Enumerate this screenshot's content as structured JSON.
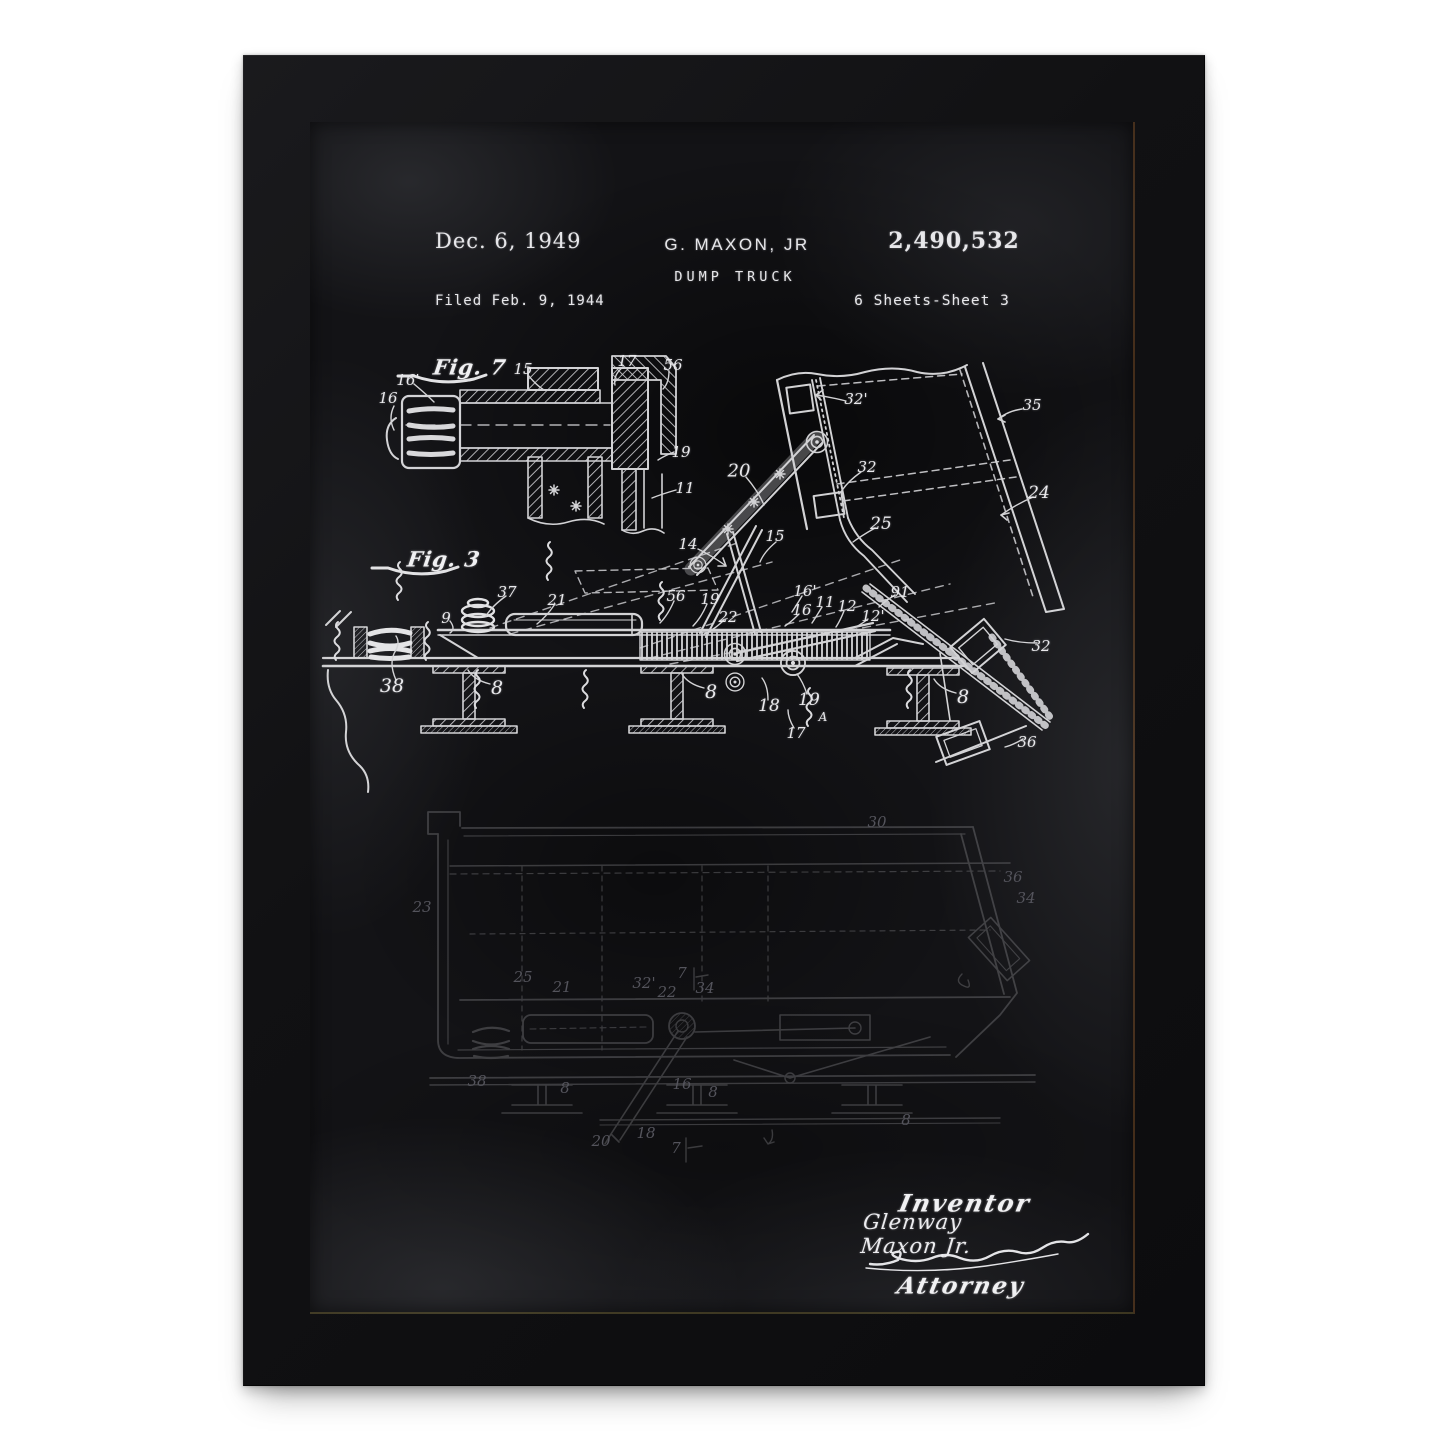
{
  "header": {
    "date": "Dec. 6, 1949",
    "inventor": "G. MAXON, JR",
    "title": "DUMP TRUCK",
    "patent_number": "2,490,532",
    "filed": "Filed Feb. 9, 1944",
    "sheet": "6 Sheets-Sheet 3"
  },
  "figures": {
    "fig7": {
      "label": "Fig. 7"
    },
    "fig3": {
      "label": "Fig. 3"
    }
  },
  "part_labels": {
    "fig7": [
      {
        "t": "16'",
        "x": 98,
        "y": 258
      },
      {
        "t": "16",
        "x": 78,
        "y": 276
      },
      {
        "t": "15",
        "x": 213,
        "y": 247
      },
      {
        "t": "17",
        "x": 317,
        "y": 239
      },
      {
        "t": "56",
        "x": 363,
        "y": 243
      },
      {
        "t": "19",
        "x": 371,
        "y": 330
      },
      {
        "t": "11",
        "x": 375,
        "y": 366
      }
    ],
    "fig3": [
      {
        "t": "14",
        "x": 378,
        "y": 422
      },
      {
        "t": "37",
        "x": 197,
        "y": 470
      },
      {
        "t": "21",
        "x": 247,
        "y": 478
      },
      {
        "t": "9",
        "x": 136,
        "y": 496
      },
      {
        "t": "56",
        "x": 366,
        "y": 474
      },
      {
        "t": "19",
        "x": 400,
        "y": 477
      },
      {
        "t": "22",
        "x": 418,
        "y": 495
      },
      {
        "t": "38",
        "x": 82,
        "y": 564,
        "s": 19
      },
      {
        "t": "8",
        "x": 187,
        "y": 566,
        "s": 19
      },
      {
        "t": "8",
        "x": 401,
        "y": 570,
        "s": 19
      },
      {
        "t": "8",
        "x": 653,
        "y": 575,
        "s": 19
      },
      {
        "t": "20",
        "x": 429,
        "y": 349,
        "s": 18
      },
      {
        "t": "32'",
        "x": 546,
        "y": 277
      },
      {
        "t": "35",
        "x": 722,
        "y": 283
      },
      {
        "t": "32",
        "x": 557,
        "y": 345
      },
      {
        "t": "24",
        "x": 729,
        "y": 371,
        "s": 17
      },
      {
        "t": "25",
        "x": 571,
        "y": 402,
        "s": 17
      },
      {
        "t": "15",
        "x": 465,
        "y": 414
      },
      {
        "t": "91",
        "x": 590,
        "y": 470
      },
      {
        "t": "16'",
        "x": 495,
        "y": 469
      },
      {
        "t": "16",
        "x": 492,
        "y": 488
      },
      {
        "t": "11",
        "x": 515,
        "y": 480
      },
      {
        "t": "12",
        "x": 537,
        "y": 484
      },
      {
        "t": "12'",
        "x": 563,
        "y": 494
      },
      {
        "t": "18",
        "x": 459,
        "y": 584,
        "s": 17
      },
      {
        "t": "19",
        "x": 499,
        "y": 578,
        "s": 17
      },
      {
        "t": "17",
        "x": 486,
        "y": 611
      },
      {
        "t": "A",
        "x": 513,
        "y": 595,
        "s": 12
      },
      {
        "t": "32",
        "x": 731,
        "y": 524
      },
      {
        "t": "36",
        "x": 717,
        "y": 620
      }
    ],
    "bottom": [
      {
        "t": "23",
        "x": 112,
        "y": 785
      },
      {
        "t": "30",
        "x": 567,
        "y": 700
      },
      {
        "t": "36",
        "x": 703,
        "y": 755
      },
      {
        "t": "34",
        "x": 716,
        "y": 776
      },
      {
        "t": "25",
        "x": 213,
        "y": 855
      },
      {
        "t": "21",
        "x": 252,
        "y": 865
      },
      {
        "t": "32'",
        "x": 334,
        "y": 861
      },
      {
        "t": "22",
        "x": 357,
        "y": 870
      },
      {
        "t": "7",
        "x": 372,
        "y": 851
      },
      {
        "t": "34",
        "x": 395,
        "y": 866
      },
      {
        "t": "38",
        "x": 167,
        "y": 959
      },
      {
        "t": "8",
        "x": 255,
        "y": 966
      },
      {
        "t": "16",
        "x": 372,
        "y": 962
      },
      {
        "t": "8",
        "x": 403,
        "y": 970
      },
      {
        "t": "8",
        "x": 596,
        "y": 998
      },
      {
        "t": "18",
        "x": 336,
        "y": 1011
      },
      {
        "t": "20",
        "x": 291,
        "y": 1019
      },
      {
        "t": "7",
        "x": 366,
        "y": 1026
      }
    ]
  },
  "signature": {
    "inventor_label": "Inventor",
    "inventor_name": "Glenway Maxon Jr.",
    "attorney_label": "Attorney"
  },
  "colors": {
    "background": "#ffffff",
    "frame": "#121214",
    "paper": "#131316",
    "chalk": "#e6e6e8",
    "rabbet": "#8c5a23"
  }
}
